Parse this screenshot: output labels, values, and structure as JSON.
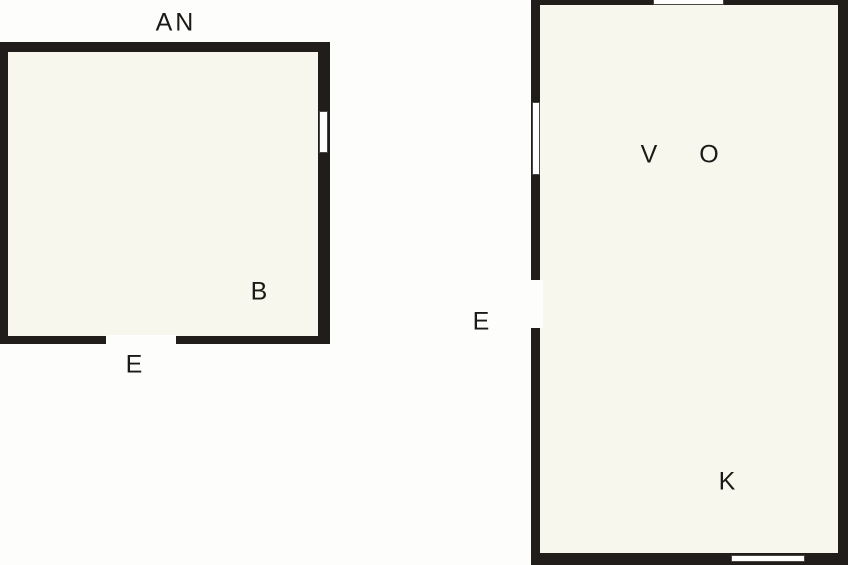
{
  "floorplan": {
    "type": "floor-plan",
    "colors": {
      "background": "#fdfdfc",
      "wall": "#201d1a",
      "floor": "#f8f7ee",
      "window": "#ffffff",
      "label": "#1c1a17"
    },
    "rooms": [
      {
        "id": "room-an",
        "title_label": "AN",
        "inner_labels": [
          "B"
        ],
        "entrance_label": "E",
        "features": [
          "window-right-wall",
          "door-opening-bottom-wall"
        ]
      },
      {
        "id": "room-vok",
        "inner_labels": [
          "V",
          "O",
          "K"
        ],
        "entrance_label": "E",
        "features": [
          "window-top-wall",
          "window-left-wall",
          "door-opening-left-wall",
          "window-bottom-wall"
        ]
      }
    ],
    "labels": [
      {
        "id": "room1-title",
        "text": "AN"
      },
      {
        "id": "room1-b",
        "text": "B"
      },
      {
        "id": "room1-entrance",
        "text": "E"
      },
      {
        "id": "room2-entrance",
        "text": "E"
      },
      {
        "id": "room2-v",
        "text": "V"
      },
      {
        "id": "room2-o",
        "text": "O"
      },
      {
        "id": "room2-k",
        "text": "K"
      }
    ]
  }
}
